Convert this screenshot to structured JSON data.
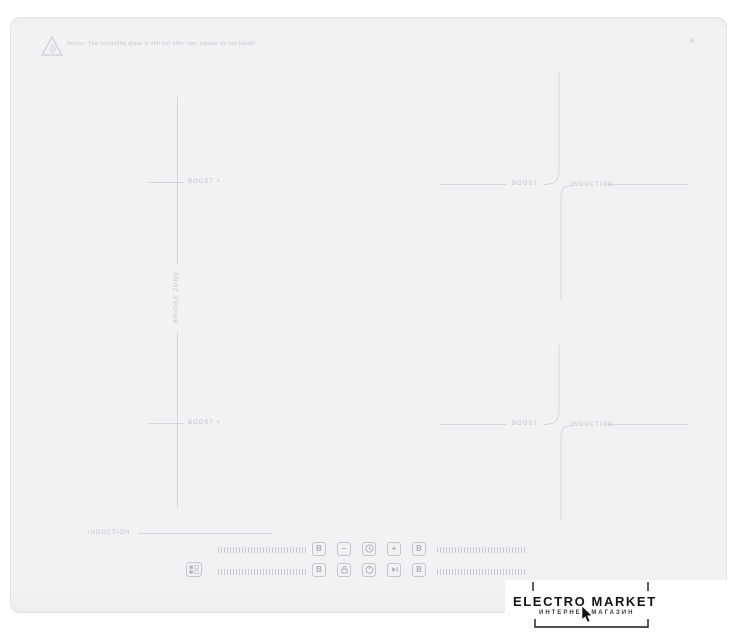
{
  "photo": {
    "surface_color": "#f2f2f4",
    "marking_color": "#d6d6da",
    "warning": {
      "icon": "warning-triangle-icon",
      "text": "Notice: The crystallite glass is still hot after use, please do not touch!"
    },
    "brand_glyph": "✳",
    "zones": {
      "flex_left": {
        "top_label": "BOOST +",
        "bottom_label": "BOOST +",
        "center_label": "BRIDGE ZONE"
      },
      "top_right": {
        "boost": "BOOST",
        "induction": "INDUCTION"
      },
      "bottom_right": {
        "boost": "BOOST",
        "induction": "INDUCTION"
      },
      "bottom_left": {
        "induction": "INDUCTION"
      }
    },
    "controls": {
      "row1": {
        "boost_left": "B",
        "minus": "−",
        "timer": "timer-icon",
        "plus": "+",
        "boost_right": "B"
      },
      "row2": {
        "boost_left": "B",
        "lock": "lock-icon",
        "power": "power-icon",
        "pause": "play-icon",
        "boost_right": "B"
      }
    }
  },
  "watermark": {
    "title": "ELECTRO MARKET",
    "subtitle": "ИНТЕРНЕТ-МАГАЗИН"
  }
}
